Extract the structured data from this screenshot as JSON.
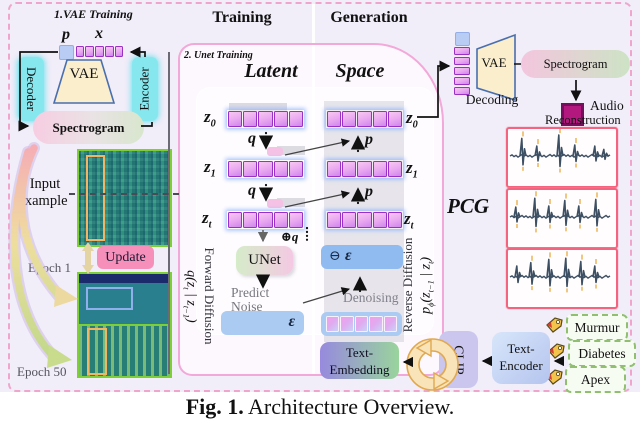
{
  "figure": {
    "caption_prefix": "Fig. 1.",
    "caption_text": "Architecture Overview."
  },
  "vae_training": {
    "title": "1.VAE Training",
    "p": "p",
    "x": "x",
    "vae": "VAE",
    "decoder": "Decoder",
    "encoder": "Encoder",
    "spectrogram": "Spectrogram",
    "input_line1": "Input",
    "input_line2": "example",
    "update": "Update",
    "epoch1": "Epoch 1",
    "epoch50": "Epoch 50"
  },
  "unet_training": {
    "training_header": "Training",
    "generation_header": "Generation",
    "title": "2. Unet Training",
    "latent": "Latent",
    "space": "Space",
    "z": "z",
    "sub0": "0",
    "sub1": "1",
    "subt": "t",
    "q": "q",
    "p": "p",
    "unet": "UNet",
    "plus_q": "⊕q",
    "predict_line1": "Predict",
    "predict_line2": "Noise",
    "epsilon": "ε",
    "minus": "⊖",
    "denoising": "Denoising",
    "forward_label": "Forward Diffusion",
    "forward_formula_parts": {
      "fn": "q",
      "open": "(z",
      "s1": "t",
      "bar": " | z",
      "s2": "t−1",
      "close": ")"
    },
    "reverse_label": "Reverse Diffusion",
    "reverse_formula_parts": {
      "fn": "p",
      "fsub": "ϕ",
      "open": "(z",
      "s1": "t−1",
      "bar": " | z",
      "s2": "t",
      "close": ")"
    },
    "text_embedding_line1": "Text-",
    "text_embedding_line2": "Embedding"
  },
  "generation_output": {
    "vae": "VAE",
    "decoding": "Decoding",
    "spectrogram": "Spectrogram",
    "audio_line1": "Audio",
    "audio_line2": "Reconstruction",
    "pcg": "PCG"
  },
  "conditioning": {
    "clip": "CLIP",
    "text_encoder_line1": "Text-",
    "text_encoder_line2": "Encoder",
    "tags": [
      "Murmur",
      "Diabetes",
      "Apex"
    ]
  },
  "colors": {
    "figure_bg": "#f1edf9",
    "outer_border": "#f0a6cc",
    "panel_border": "#f2a8d8",
    "panel_fill": "#fdf8fd",
    "token_fill_a": "#f8c8f2",
    "token_fill_b": "#cf86ec",
    "token_border": "#9a30c4",
    "cyan": "#86e8ee",
    "vae_fill": "#fbeecd",
    "vae_border": "#4a6fae",
    "green_border": "#7ccf35",
    "pcg_border": "#f4647e",
    "tag_green": "#8fbf6f",
    "audio_magenta": "#b3187e",
    "waveform": "#3d4f63",
    "blue_box": "#abcbf2",
    "blue_box_dark": "#8fbbf0",
    "update_pink": "#f690ba"
  }
}
